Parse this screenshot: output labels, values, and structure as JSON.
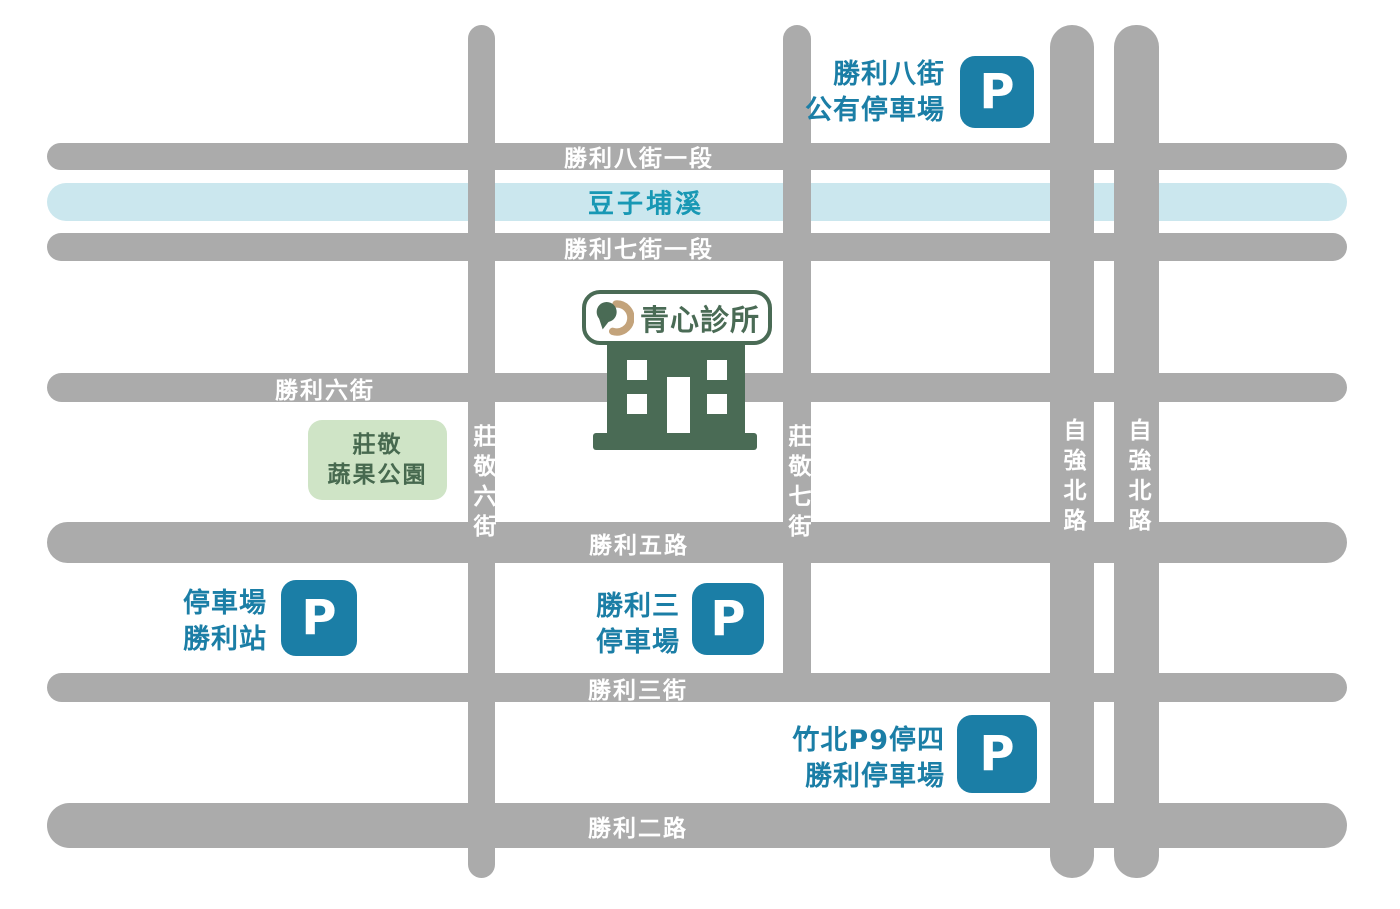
{
  "map_title": "青心診所周邊停車地圖",
  "colors": {
    "road_gray": "#ABABAB",
    "road_label_white": "#FFFFFF",
    "river_fill": "#CBE7EE",
    "river_text": "#1898B4",
    "parking_blue": "#1B7EA6",
    "clinic_green": "#4A6B55",
    "logo_tan": "#C3A37B",
    "park_fill": "#CFE4C6",
    "park_text": "#47694F"
  },
  "river": {
    "label": "豆子埔溪"
  },
  "roads_horizontal": [
    {
      "id": "shengli-8th-st-sec1",
      "label": "勝利八街一段"
    },
    {
      "id": "shengli-7th-st-sec1",
      "label": "勝利七街一段"
    },
    {
      "id": "shengli-6th-st",
      "label": "勝利六街"
    },
    {
      "id": "shengli-5th-rd",
      "label": "勝利五路"
    },
    {
      "id": "shengli-3rd-st",
      "label": "勝利三街"
    },
    {
      "id": "shengli-2nd-rd",
      "label": "勝利二路"
    }
  ],
  "roads_vertical": [
    {
      "id": "zhuangjing-6th-st",
      "label": "莊敬六街"
    },
    {
      "id": "zhuangjing-7th-st",
      "label": "莊敬七街"
    },
    {
      "id": "ziqiang-n-rd-west",
      "label": "自強北路"
    },
    {
      "id": "ziqiang-n-rd-east",
      "label": "自強北路"
    }
  ],
  "park": {
    "line1": "莊敬",
    "line2": "蔬果公園"
  },
  "clinic": {
    "name": "青心診所"
  },
  "parkings": [
    {
      "id": "shengli-8th-public-lot",
      "line1": "勝利八街",
      "line2": "公有停車場",
      "icon_letter": "P"
    },
    {
      "id": "shengli-station-lot",
      "line1": "停車場",
      "line2": "勝利站",
      "icon_letter": "P"
    },
    {
      "id": "shengli-3-lot",
      "line1": "勝利三",
      "line2": "停車場",
      "icon_letter": "P"
    },
    {
      "id": "zhubei-p9-lot",
      "line1": "竹北P9停四",
      "line2": "勝利停車場",
      "icon_letter": "P"
    }
  ]
}
